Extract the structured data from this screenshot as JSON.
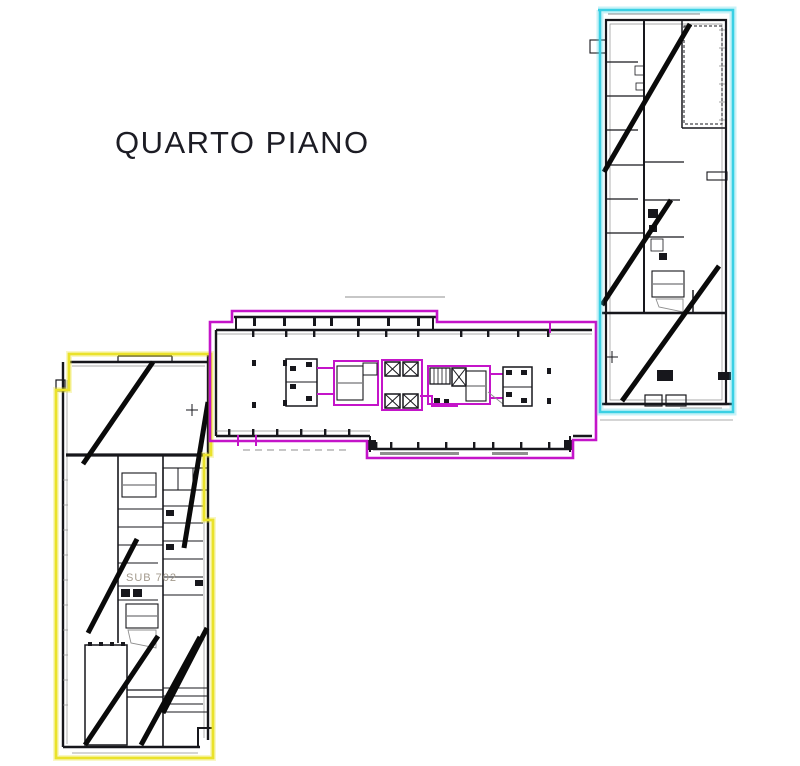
{
  "title": "QUARTO PIANO",
  "floor_plan": {
    "unit_label": "SUB 702",
    "wings": [
      {
        "id": "wing-top-right",
        "outline_color": "#3ad0e4"
      },
      {
        "id": "wing-center",
        "outline_color": "#c414c9"
      },
      {
        "id": "wing-bottom-left",
        "outline_color": "#eae22b"
      }
    ]
  },
  "colors": {
    "background": "#ffffff",
    "walls": "#17171c",
    "gray_detail": "#8f8f8f",
    "slash": "#0a0a0a",
    "cyan": "#3ad0e4",
    "magenta": "#c414c9",
    "yellow": "#eae22b",
    "faint_label": "#a39a8d",
    "title_text": "#1c1c24"
  }
}
